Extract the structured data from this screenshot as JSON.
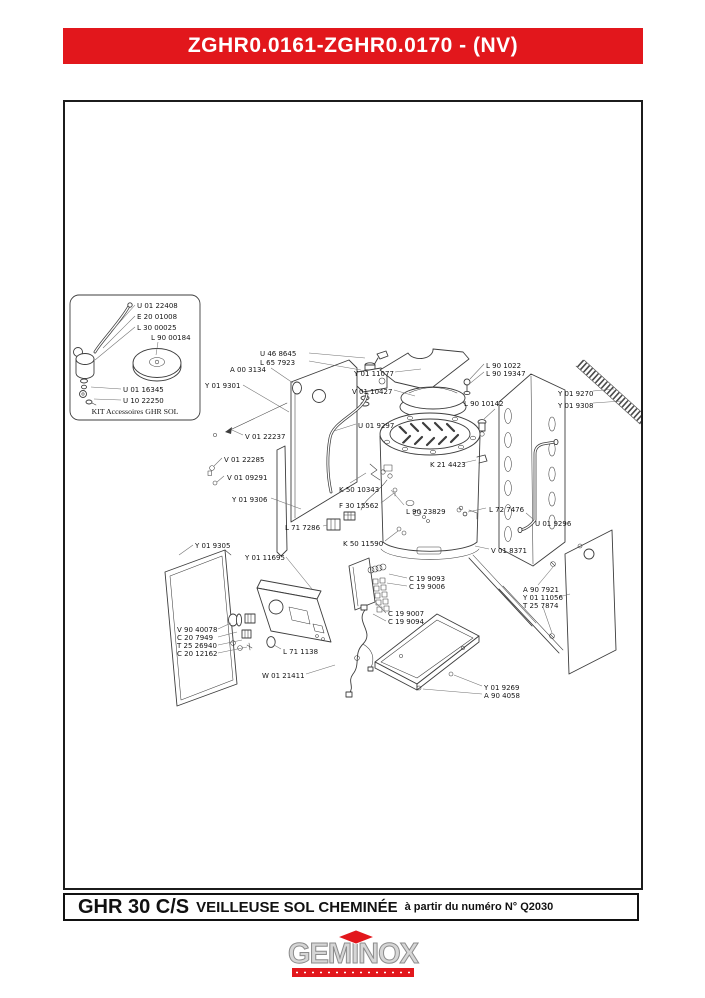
{
  "colors": {
    "accent_red": "#e2171c",
    "ink": "#1c1c1c"
  },
  "header": {
    "title": "ZGHR0.0161-ZGHR0.0170 - (NV)"
  },
  "inset": {
    "caption": "KIT Accessoires GHR SOL",
    "labels": [
      "U 01 22408",
      "E 20 01008",
      "L 30 00025",
      "L 90 00184",
      "U 01 16345",
      "U 10 22250"
    ]
  },
  "diagram": {
    "labels": [
      "U 46 8645",
      "L 65 7923",
      "A 00 3134",
      "Y 01 9301",
      "Y 01 11077",
      "V 01 10427",
      "L 90 1022",
      "L 90 19347",
      "L 90 10142",
      "Y 01 9270",
      "Y 01 9308",
      "U 01 9297",
      "V 01 22237",
      "V 01 22285",
      "V 01 09291",
      "K 21 4423",
      "K 50 10343",
      "F 30 15562",
      "Y 01 9306",
      "L 90 23829",
      "L 72 7476",
      "U 01 9296",
      "L 71 7286",
      "K 50 11590",
      "Y 01 9305",
      "V 01 8371",
      "Y 01 11695",
      "C 19 9093",
      "C 19 9006",
      "A 90 7921",
      "Y 01 11056",
      "T 25 7874",
      "C 19 9007",
      "C 19 9094",
      "V 90 40078",
      "C 20 7949",
      "T 25 26940",
      "C 20 12162",
      "L 71 1138",
      "W 01 21411",
      "Y 01 9269",
      "A 90 4058"
    ]
  },
  "footer": {
    "model": "GHR 30 C/S",
    "name": "VEILLEUSE SOL CHEMINÉE",
    "note": "à partir du numéro N° Q2030"
  },
  "logo": {
    "brand": "GEMINOX"
  }
}
